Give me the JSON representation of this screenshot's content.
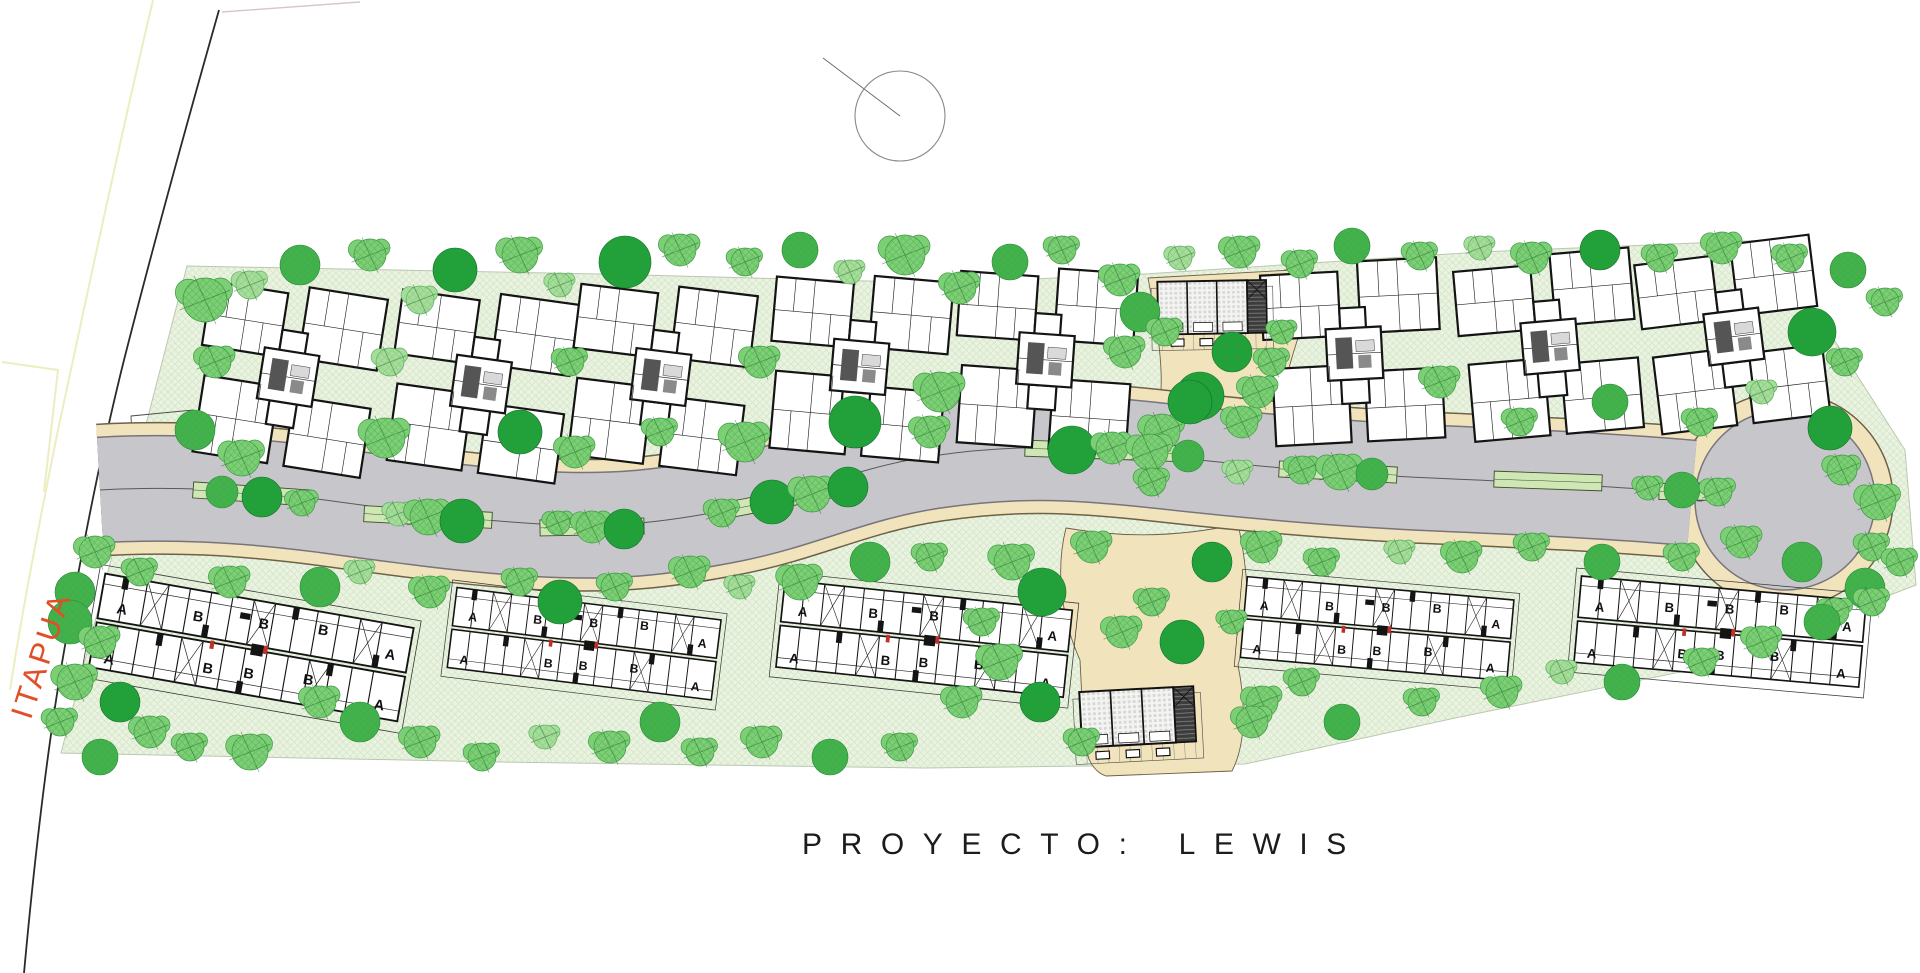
{
  "labels": {
    "project_prefix": "PROYECTO:",
    "project_name": "LEWIS",
    "street_name": "ITAPUA"
  },
  "colors": {
    "site_fill": "#eaf3e1",
    "site_edge": "#b9c4ae",
    "road_gray": "#c7c6ca",
    "road_edge": "#77747c",
    "walk_tan": "#f1e3bb",
    "walk_edge": "#6d6148",
    "median_green": "#cfe7b4",
    "median_edge": "#3f4b2d",
    "street_label_color": "#e14f28",
    "boundary_black": "#2a2a2a",
    "boundary_yellow": "#ededc2",
    "boundary_pink": "#d8c6c6",
    "tree_fills": [
      "#22a03a",
      "#43b24c",
      "#7ccf74",
      "#a6dd9a"
    ],
    "tree_strokes": [
      "#167029",
      "#2b8a38",
      "#3d9a46",
      "#5cb163"
    ]
  },
  "north_symbol": {
    "cx": 900,
    "cy": 116,
    "r": 45,
    "line": [
      823,
      58,
      900,
      116
    ]
  },
  "site": {
    "outline": "187,266 600,274 945,283 1145,274 1480,252 1770,240 1905,450 1916,585 1700,668 1455,718 1245,764 925,768 500,762 61,753"
  },
  "boundary_lines": {
    "street_line": "M219,10 C185,130 152,250 124,360 C102,448 84,540 66,640 C52,718 38,820 24,973",
    "yellow_lines": [
      "M153,0 C120,140 88,290 58,430 C40,520 24,600 10,690",
      "M2,362 L58,370 L44,492"
    ],
    "pink_line": "M222,12 L360,2",
    "gate_rect": "131,416 193,410 199,546 137,552"
  },
  "road": {
    "centerline": "M100,490 C170,486 240,489 325,500 C405,511 470,520 540,524 C612,528 662,523 732,509 C802,495 852,468 932,456 C1012,444 1072,446 1162,456 C1252,466 1342,474 1432,478 C1522,482 1612,486 1692,493",
    "gray_width": 104,
    "tan_width": 130,
    "bulb": {
      "cx": 1785,
      "cy": 500,
      "gray_r": 90,
      "tan_r": 108
    },
    "turn_circle": {
      "cx": 1700,
      "cy": 492,
      "r": 9
    },
    "medians": [
      {
        "x": 252,
        "y": 494,
        "len": 118,
        "rot": 4
      },
      {
        "x": 428,
        "y": 517,
        "len": 128,
        "rot": 3
      },
      {
        "x": 592,
        "y": 527,
        "len": 104,
        "rot": -1
      },
      {
        "x": 795,
        "y": 497,
        "len": 138,
        "rot": -11
      },
      {
        "x": 1105,
        "y": 451,
        "len": 160,
        "rot": 2
      },
      {
        "x": 1338,
        "y": 472,
        "len": 118,
        "rot": 3
      },
      {
        "x": 1548,
        "y": 481,
        "len": 108,
        "rot": 2
      },
      {
        "x": 1692,
        "y": 492,
        "len": 66,
        "rot": 1
      }
    ]
  },
  "plazas": {
    "top": "M1148,278 L1292,270 L1300,332 C1290,362 1282,388 1286,404 L1284,414 C1240,402 1200,404 1158,414 C1166,380 1158,330 1148,278 Z",
    "bottom": "M1066,528 C1054,575 1064,625 1080,660 L1082,700 C1080,745 1088,770 1106,776 L1232,771 C1247,742 1245,700 1238,665 C1252,618 1248,570 1238,524 C1180,537 1122,538 1066,528 Z"
  },
  "buildings": {
    "type_a": [
      {
        "x": 285,
        "y": 385,
        "rot": 9
      },
      {
        "x": 478,
        "y": 392,
        "rot": 8
      },
      {
        "x": 658,
        "y": 385,
        "rot": 7
      },
      {
        "x": 857,
        "y": 375,
        "rot": 5
      },
      {
        "x": 1043,
        "y": 368,
        "rot": 4
      },
      {
        "x": 1353,
        "y": 362,
        "rot": -3
      },
      {
        "x": 1549,
        "y": 355,
        "rot": -5
      },
      {
        "x": 1733,
        "y": 345,
        "rot": -7
      }
    ],
    "type_a_scale": 0.92,
    "type_b": [
      {
        "x": 251,
        "y": 649,
        "rot": 10,
        "scale": 1.03
      },
      {
        "x": 584,
        "y": 645,
        "rot": 7,
        "scale": 0.875
      },
      {
        "x": 924,
        "y": 640,
        "rot": 6,
        "scale": 0.95
      },
      {
        "x": 1377,
        "y": 630,
        "rot": 5,
        "scale": 0.88
      },
      {
        "x": 1720,
        "y": 633,
        "rot": 5,
        "scale": 0.94
      }
    ],
    "unit_letter_layout": [
      [
        "A",
        30,
        46
      ],
      [
        "B",
        104,
        40
      ],
      [
        "B",
        168,
        36
      ],
      [
        "B",
        226,
        32
      ],
      [
        "A",
        292,
        94
      ],
      [
        "A",
        26,
        96
      ],
      [
        "B",
        122,
        88
      ],
      [
        "B",
        162,
        86
      ],
      [
        "B",
        220,
        82
      ],
      [
        "A",
        294,
        44
      ]
    ],
    "clubhouses": [
      {
        "x": 1214,
        "y": 318,
        "rot": -1,
        "scale": 0.8
      },
      {
        "x": 1140,
        "y": 728,
        "rot": -3,
        "scale": 0.84
      }
    ]
  },
  "trees": [
    [
      205,
      300,
      22,
      2
    ],
    [
      250,
      285,
      14,
      3
    ],
    [
      300,
      265,
      20,
      1
    ],
    [
      370,
      255,
      16,
      2
    ],
    [
      420,
      300,
      14,
      3
    ],
    [
      455,
      270,
      22,
      0
    ],
    [
      520,
      255,
      18,
      2
    ],
    [
      560,
      285,
      12,
      3
    ],
    [
      625,
      262,
      26,
      0
    ],
    [
      680,
      250,
      16,
      2
    ],
    [
      745,
      262,
      14,
      2
    ],
    [
      800,
      250,
      18,
      1
    ],
    [
      850,
      272,
      12,
      3
    ],
    [
      905,
      255,
      20,
      2
    ],
    [
      960,
      288,
      16,
      2
    ],
    [
      1010,
      262,
      18,
      1
    ],
    [
      1062,
      250,
      14,
      2
    ],
    [
      1120,
      280,
      16,
      2
    ],
    [
      1180,
      258,
      12,
      3
    ],
    [
      1240,
      252,
      16,
      2
    ],
    [
      1300,
      264,
      14,
      2
    ],
    [
      1352,
      246,
      18,
      1
    ],
    [
      1420,
      256,
      14,
      2
    ],
    [
      1480,
      248,
      12,
      3
    ],
    [
      1532,
      258,
      16,
      2
    ],
    [
      1600,
      250,
      20,
      0
    ],
    [
      1660,
      258,
      14,
      2
    ],
    [
      1722,
      248,
      16,
      2
    ],
    [
      1790,
      258,
      14,
      2
    ],
    [
      1848,
      270,
      18,
      1
    ],
    [
      1885,
      302,
      14,
      2
    ],
    [
      1812,
      332,
      24,
      0
    ],
    [
      1845,
      362,
      14,
      2
    ],
    [
      1830,
      428,
      22,
      0
    ],
    [
      1842,
      470,
      15,
      2
    ],
    [
      215,
      362,
      16,
      2
    ],
    [
      195,
      430,
      20,
      1
    ],
    [
      242,
      458,
      18,
      2
    ],
    [
      390,
      362,
      14,
      3
    ],
    [
      385,
      438,
      20,
      2
    ],
    [
      520,
      432,
      22,
      0
    ],
    [
      570,
      362,
      14,
      2
    ],
    [
      575,
      452,
      16,
      2
    ],
    [
      660,
      432,
      14,
      2
    ],
    [
      760,
      362,
      16,
      2
    ],
    [
      745,
      442,
      20,
      2
    ],
    [
      855,
      422,
      26,
      0
    ],
    [
      940,
      392,
      20,
      2
    ],
    [
      930,
      432,
      16,
      2
    ],
    [
      1140,
      312,
      20,
      1
    ],
    [
      1125,
      352,
      16,
      2
    ],
    [
      1200,
      396,
      24,
      0
    ],
    [
      1242,
      422,
      16,
      2
    ],
    [
      1272,
      362,
      14,
      2
    ],
    [
      1162,
      432,
      18,
      2
    ],
    [
      1440,
      382,
      16,
      2
    ],
    [
      1520,
      422,
      14,
      2
    ],
    [
      1610,
      402,
      18,
      1
    ],
    [
      1700,
      422,
      14,
      2
    ],
    [
      1762,
      392,
      12,
      3
    ],
    [
      222,
      492,
      16,
      1
    ],
    [
      262,
      497,
      20,
      0
    ],
    [
      302,
      503,
      13,
      2
    ],
    [
      398,
      514,
      12,
      3
    ],
    [
      428,
      517,
      18,
      2
    ],
    [
      462,
      521,
      22,
      0
    ],
    [
      558,
      523,
      12,
      2
    ],
    [
      592,
      527,
      16,
      2
    ],
    [
      624,
      529,
      20,
      0
    ],
    [
      722,
      513,
      14,
      2
    ],
    [
      772,
      502,
      22,
      0
    ],
    [
      812,
      494,
      18,
      2
    ],
    [
      848,
      487,
      20,
      0
    ],
    [
      1072,
      450,
      24,
      0
    ],
    [
      1112,
      448,
      16,
      2
    ],
    [
      1150,
      452,
      18,
      2
    ],
    [
      1188,
      456,
      16,
      1
    ],
    [
      1302,
      470,
      14,
      2
    ],
    [
      1340,
      472,
      18,
      2
    ],
    [
      1372,
      474,
      16,
      1
    ],
    [
      1648,
      488,
      12,
      2
    ],
    [
      1682,
      490,
      18,
      1
    ],
    [
      1718,
      492,
      14,
      2
    ],
    [
      95,
      552,
      16,
      2
    ],
    [
      75,
      592,
      20,
      1
    ],
    [
      140,
      572,
      14,
      2
    ],
    [
      230,
      582,
      16,
      2
    ],
    [
      320,
      587,
      20,
      1
    ],
    [
      360,
      572,
      12,
      3
    ],
    [
      430,
      592,
      16,
      2
    ],
    [
      520,
      582,
      14,
      2
    ],
    [
      560,
      602,
      22,
      0
    ],
    [
      615,
      587,
      14,
      2
    ],
    [
      690,
      572,
      16,
      2
    ],
    [
      740,
      587,
      12,
      3
    ],
    [
      800,
      582,
      18,
      2
    ],
    [
      870,
      562,
      20,
      1
    ],
    [
      930,
      557,
      14,
      2
    ],
    [
      1012,
      562,
      18,
      2
    ],
    [
      1042,
      592,
      24,
      0
    ],
    [
      1262,
      547,
      16,
      2
    ],
    [
      1322,
      562,
      14,
      2
    ],
    [
      1400,
      552,
      12,
      3
    ],
    [
      1462,
      557,
      16,
      2
    ],
    [
      1532,
      547,
      14,
      2
    ],
    [
      1602,
      562,
      18,
      1
    ],
    [
      1682,
      557,
      14,
      2
    ],
    [
      1742,
      542,
      16,
      2
    ],
    [
      1802,
      562,
      20,
      1
    ],
    [
      1872,
      547,
      14,
      2
    ],
    [
      1878,
      502,
      18,
      2
    ],
    [
      1900,
      562,
      14,
      2
    ],
    [
      1865,
      588,
      20,
      1
    ],
    [
      1835,
      612,
      14,
      2
    ],
    [
      70,
      622,
      22,
      1
    ],
    [
      100,
      642,
      16,
      2
    ],
    [
      75,
      682,
      18,
      2
    ],
    [
      120,
      702,
      20,
      0
    ],
    [
      60,
      722,
      14,
      2
    ],
    [
      150,
      732,
      16,
      2
    ],
    [
      100,
      757,
      18,
      1
    ],
    [
      190,
      747,
      14,
      2
    ],
    [
      250,
      752,
      18,
      2
    ],
    [
      320,
      702,
      16,
      2
    ],
    [
      360,
      722,
      20,
      1
    ],
    [
      420,
      742,
      16,
      2
    ],
    [
      482,
      757,
      14,
      2
    ],
    [
      545,
      737,
      12,
      3
    ],
    [
      610,
      747,
      16,
      2
    ],
    [
      660,
      722,
      20,
      1
    ],
    [
      700,
      752,
      14,
      2
    ],
    [
      762,
      742,
      16,
      2
    ],
    [
      830,
      757,
      18,
      1
    ],
    [
      900,
      747,
      14,
      2
    ],
    [
      962,
      702,
      16,
      2
    ],
    [
      1000,
      662,
      18,
      2
    ],
    [
      982,
      622,
      14,
      2
    ],
    [
      1040,
      702,
      20,
      0
    ],
    [
      1262,
      702,
      16,
      2
    ],
    [
      1302,
      682,
      14,
      2
    ],
    [
      1342,
      722,
      18,
      1
    ],
    [
      1422,
      702,
      14,
      2
    ],
    [
      1502,
      692,
      16,
      2
    ],
    [
      1562,
      672,
      12,
      3
    ],
    [
      1622,
      682,
      18,
      1
    ],
    [
      1702,
      662,
      14,
      2
    ],
    [
      1762,
      642,
      16,
      2
    ],
    [
      1822,
      622,
      18,
      1
    ],
    [
      1872,
      602,
      14,
      2
    ],
    [
      1165,
      332,
      14,
      2
    ],
    [
      1232,
      352,
      20,
      0
    ],
    [
      1282,
      332,
      12,
      2
    ],
    [
      1190,
      402,
      22,
      0
    ],
    [
      1258,
      392,
      16,
      2
    ],
    [
      1152,
      482,
      14,
      2
    ],
    [
      1238,
      472,
      12,
      3
    ],
    [
      1092,
      547,
      16,
      2
    ],
    [
      1212,
      562,
      20,
      0
    ],
    [
      1152,
      602,
      14,
      2
    ],
    [
      1182,
      642,
      22,
      0
    ],
    [
      1122,
      632,
      16,
      2
    ],
    [
      1232,
      622,
      12,
      2
    ],
    [
      1082,
      742,
      14,
      2
    ],
    [
      1252,
      722,
      16,
      2
    ]
  ]
}
